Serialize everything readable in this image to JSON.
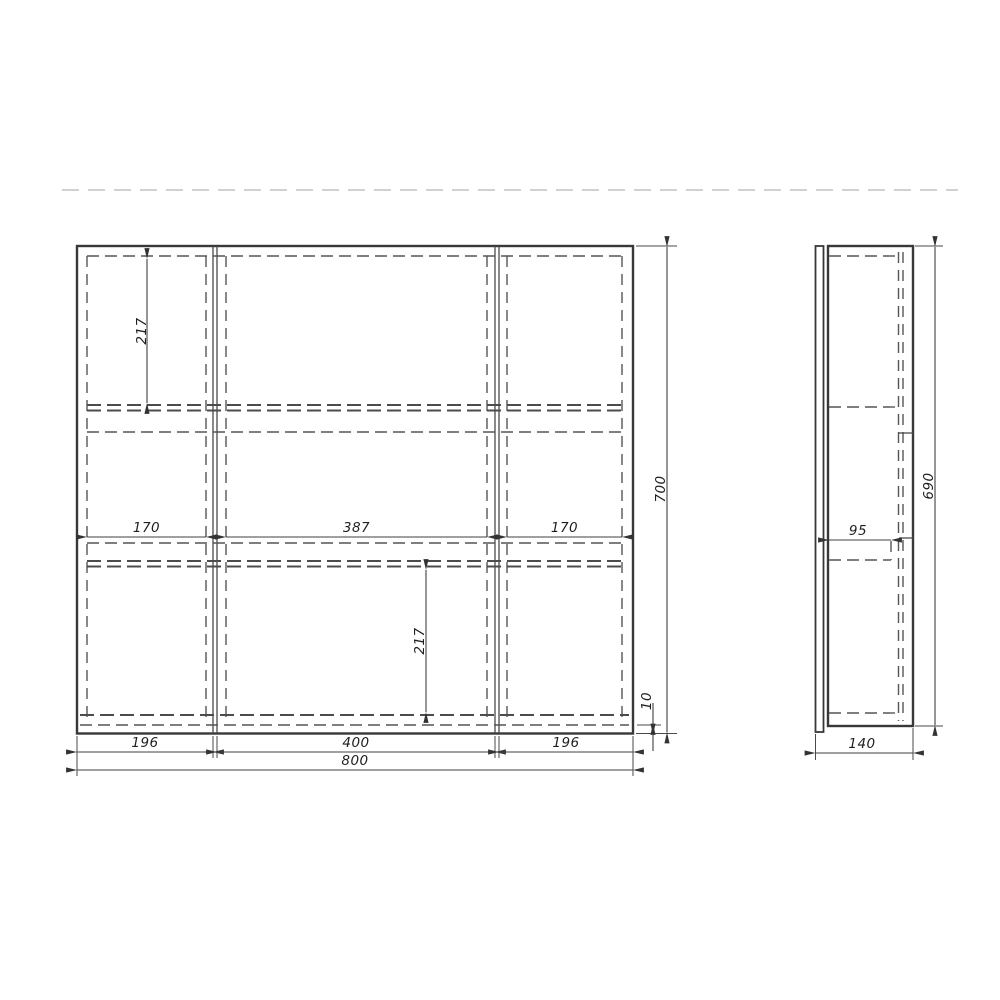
{
  "drawing": {
    "kind": "three-door mirror cabinet dimensional drawing",
    "colors": {
      "background": "#ffffff",
      "main_line": "#383838",
      "hidden_line": "#555555",
      "faint_reference_line": "#c2c2c2",
      "text": "#1f1f1f"
    }
  },
  "dims": {
    "front": {
      "total_width": "800",
      "door_left_width": "196",
      "door_mid_width": "400",
      "door_right_width": "196",
      "inner_left_width": "170",
      "inner_mid_width": "387",
      "inner_right_width": "170",
      "total_height": "700",
      "upper_section_height": "217",
      "lower_section_height": "217",
      "bottom_offset": "10"
    },
    "side": {
      "depth": "140",
      "carcass_height": "690",
      "shelf_depth": "95"
    }
  }
}
